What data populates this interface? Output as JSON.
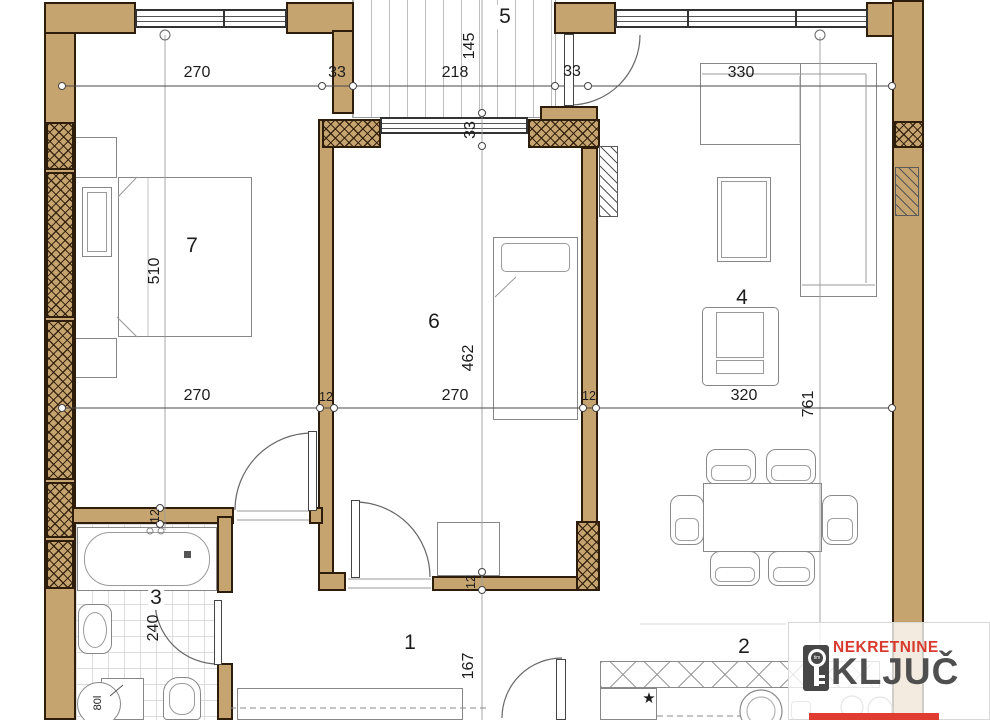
{
  "rooms": {
    "r1": "1",
    "r2": "2",
    "r3": "3",
    "r4": "4",
    "r5": "5",
    "r6": "6",
    "r7": "7"
  },
  "dims": {
    "bed7_width_top": "270",
    "wall_left_of_balcony": "33",
    "balcony_width": "218",
    "wall_right_of_balcony": "33",
    "living_width_top": "330",
    "balcony_depth": "145",
    "balcony_wall_thickness": "33",
    "bed7_height": "510",
    "bed7_width_bottom": "270",
    "partition_left": "12",
    "room6_width": "270",
    "partition_right": "12",
    "living_width": "320",
    "living_height": "761",
    "bath_wall_thickness": "12",
    "bath_height": "240",
    "hall_wall_thickness": "12",
    "hall_height": "167"
  },
  "symbols": {
    "water_heater": "80l",
    "kitchen_star": "★"
  },
  "logo": {
    "line1": "NEKRETNINE",
    "line2": "KLJUČ",
    "key_badge": "tim"
  },
  "colors": {
    "wall_fill": "#c6a46f",
    "wall_outline": "#2f1d0b",
    "logo_red": "#d93a2e",
    "logo_gray": "#4f4f4f"
  }
}
